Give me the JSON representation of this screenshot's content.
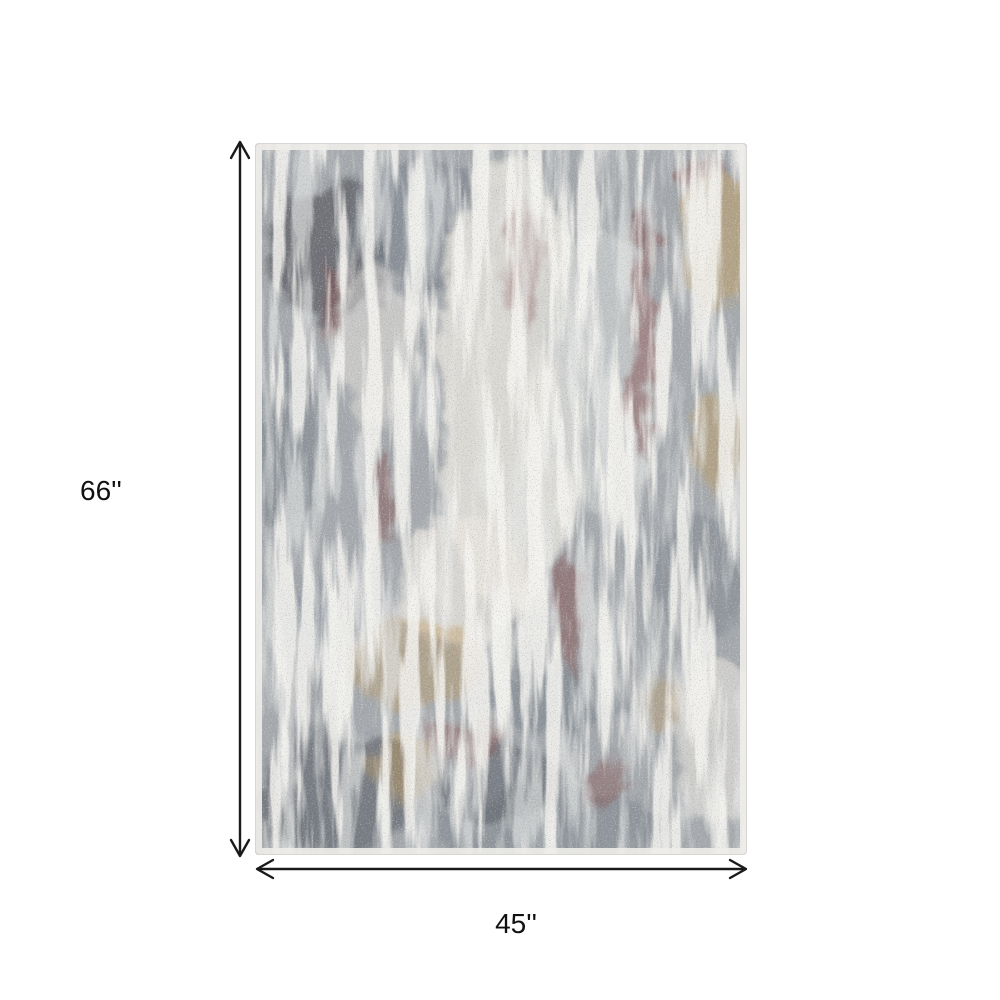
{
  "diagram": {
    "title": "rug-dimension-diagram",
    "height_label": "66''",
    "width_label": "45''",
    "arrow_color": "#1a1a1a",
    "background_color": "#ffffff"
  },
  "rug": {
    "name": "abstract-distressed-area-rug",
    "palette": {
      "base": "#a6aaae",
      "slate": "#79818a",
      "charcoal": "#42464d",
      "ivory": "#e9e6df",
      "light": "#cdd0d0",
      "gold": "#bf9b60",
      "maroon": "#7f4a49",
      "blue_slate": "#6e7e8d",
      "edge": "#eeedea",
      "edge_outline": "#d7d6d2"
    }
  }
}
